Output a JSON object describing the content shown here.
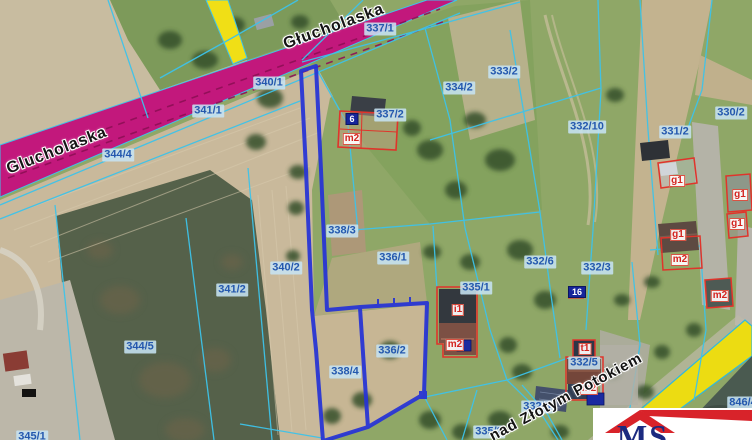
{
  "map": {
    "parcel_labels": [
      {
        "text": "337/1",
        "x": 380,
        "y": 29
      },
      {
        "text": "340/1",
        "x": 269,
        "y": 83
      },
      {
        "text": "341/1",
        "x": 208,
        "y": 111
      },
      {
        "text": "344/4",
        "x": 118,
        "y": 155
      },
      {
        "text": "334/2",
        "x": 459,
        "y": 88
      },
      {
        "text": "333/2",
        "x": 504,
        "y": 72
      },
      {
        "text": "332/10",
        "x": 587,
        "y": 127
      },
      {
        "text": "331/2",
        "x": 675,
        "y": 132
      },
      {
        "text": "330/2",
        "x": 731,
        "y": 113
      },
      {
        "text": "337/2",
        "x": 390,
        "y": 115
      },
      {
        "text": "338/3",
        "x": 342,
        "y": 231
      },
      {
        "text": "336/1",
        "x": 393,
        "y": 258
      },
      {
        "text": "340/2",
        "x": 286,
        "y": 268
      },
      {
        "text": "341/2",
        "x": 232,
        "y": 290
      },
      {
        "text": "335/1",
        "x": 476,
        "y": 288
      },
      {
        "text": "332/6",
        "x": 540,
        "y": 262
      },
      {
        "text": "332/3",
        "x": 597,
        "y": 268
      },
      {
        "text": "344/5",
        "x": 140,
        "y": 347
      },
      {
        "text": "338/4",
        "x": 345,
        "y": 372
      },
      {
        "text": "336/2",
        "x": 392,
        "y": 351
      },
      {
        "text": "332/5",
        "x": 584,
        "y": 363
      },
      {
        "text": "332/8",
        "x": 537,
        "y": 407
      },
      {
        "text": "335/2",
        "x": 489,
        "y": 432
      },
      {
        "text": "345/1",
        "x": 32,
        "y": 437
      },
      {
        "text": "846/4",
        "x": 743,
        "y": 403
      }
    ],
    "building_labels": [
      {
        "text": "m2",
        "x": 352,
        "y": 139
      },
      {
        "text": "i1",
        "x": 458,
        "y": 310
      },
      {
        "text": "m2",
        "x": 455,
        "y": 345
      },
      {
        "text": "g1",
        "x": 677,
        "y": 181
      },
      {
        "text": "g1",
        "x": 740,
        "y": 195
      },
      {
        "text": "g1",
        "x": 737,
        "y": 224
      },
      {
        "text": "g1",
        "x": 678,
        "y": 235
      },
      {
        "text": "m2",
        "x": 680,
        "y": 260
      },
      {
        "text": "m2",
        "x": 720,
        "y": 296
      },
      {
        "text": "t1",
        "x": 585,
        "y": 349
      },
      {
        "text": "m2",
        "x": 589,
        "y": 389
      }
    ],
    "house_numbers": [
      {
        "text": "6",
        "x": 352,
        "y": 119
      },
      {
        "text": "16",
        "x": 577,
        "y": 292
      }
    ],
    "road_names": [
      {
        "text": "Glucholaska",
        "x": 57,
        "y": 151,
        "rot": -21,
        "size": "big"
      },
      {
        "text": "Głucholaska",
        "x": 334,
        "y": 27,
        "rot": -20,
        "size": "big"
      },
      {
        "text": "nad Złotym Potokiem",
        "x": 566,
        "y": 397,
        "rot": -28,
        "size": "small"
      }
    ]
  },
  "logo": {
    "text": "MS"
  },
  "colors": {
    "selection_blue": "#2633d6",
    "cadastral_cyan": "#3dc3ea",
    "road_magenta": "#c2187c",
    "road_yellow": "#efdf14",
    "building_red": "#e0342b",
    "label_blue": "#2458ae",
    "logo_red": "#d8232a",
    "logo_navy": "#1b2a80"
  }
}
